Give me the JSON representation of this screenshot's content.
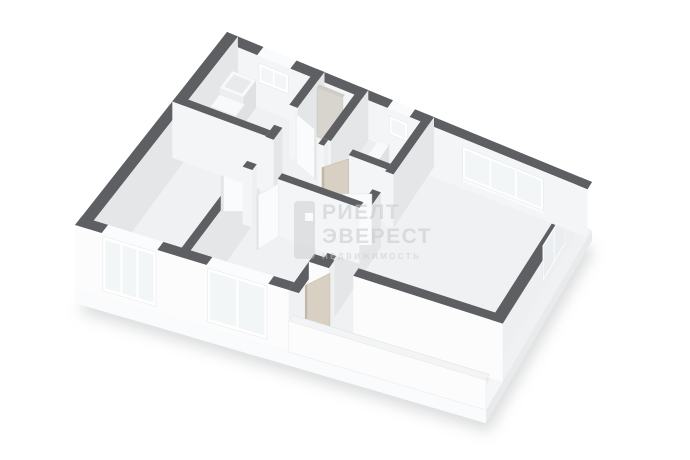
{
  "app": {
    "name": "3d-floor-plan-view",
    "background": "#ffffff"
  },
  "watermark": {
    "logo_icon": "realty-bar-logo",
    "lines": [
      "РИЕЛТ",
      "ЭВЕРЕСТ",
      "НЕДВИЖИМОСТЬ"
    ]
  },
  "scene": {
    "type": "isometric-3d-floor-plan",
    "colors": {
      "wallTop": "#5d5f62",
      "faceLit": "#f4f5f6",
      "faceBright": "#fcfcfd",
      "faceShade": "#e4e6e8",
      "faceMid": "#edeff0",
      "frame": "#ffffff",
      "glass": "#f3f6f7",
      "glassShade": "#eaeef0",
      "floor": "#f0f1f3",
      "floorBalcony": "#f5f6f7",
      "boxTop": "#f8f9fa",
      "boxFront": "#eceef0",
      "boxSide": "#dfe1e3",
      "doorWood": "#d8d1c3",
      "doorWoodEdge": "#bfb7a7",
      "doorWhite": "#fafbfc",
      "doorWhiteEdge": "#e2e4e6",
      "slabFront": "#fafbfc",
      "slabLeft": "#f4f5f6",
      "slabRight": "#e8eaec",
      "shadow": "#b9bbbd"
    },
    "rooms": [
      "kitchen",
      "hallway",
      "bathroom",
      "living-room",
      "bedroom",
      "bedroom-2",
      "balcony"
    ],
    "windows": [
      "kitchen-small",
      "bathroom-small",
      "living-triple",
      "living-side",
      "bedroom-left",
      "bedroom-middle",
      "balcony-end"
    ],
    "doors": [
      "kitchen",
      "entrance-panel",
      "bathroom",
      "living-to-corridor",
      "bedroom-middle",
      "bedroom-left",
      "balcony"
    ],
    "fixtures": [
      "kitchen-cabinet",
      "kitchen-counter-sink",
      "washing-machine"
    ]
  }
}
